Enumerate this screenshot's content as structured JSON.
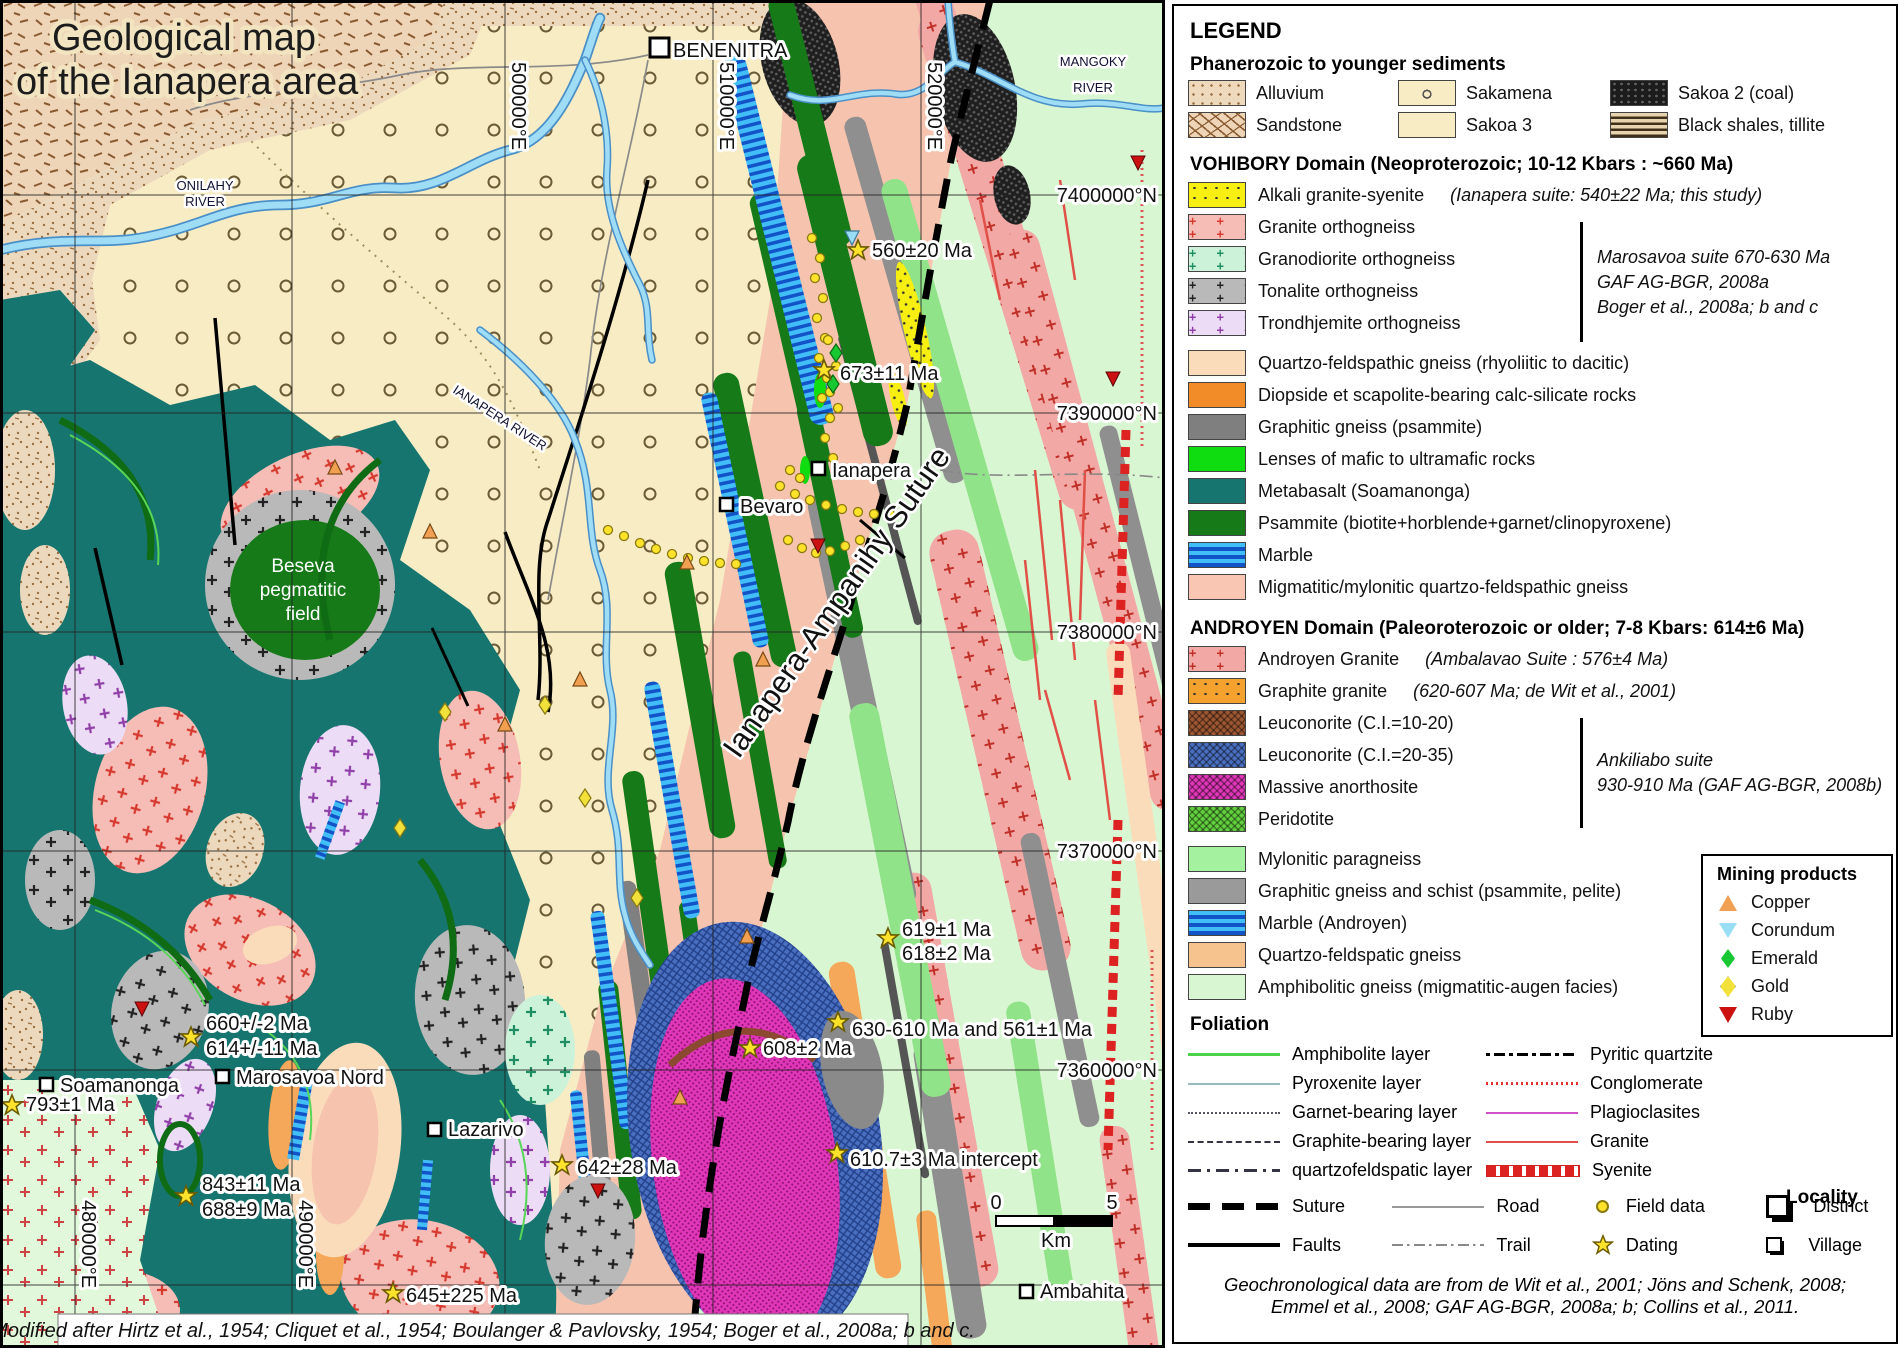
{
  "map": {
    "title": [
      "Geological map",
      "of the Ianapera area"
    ],
    "river_labels": {
      "mangoky_1": "MANGOKY",
      "mangoky_2": "RIVER",
      "onilahy_1": "ONILAHY",
      "onilahy_2": "RIVER",
      "ianapera": "IANAPERA RIVER"
    },
    "suture_label": "Ianapera-Ampanihy Suture",
    "beseva": [
      "Beseva",
      "pegmatitic",
      "field"
    ],
    "localities": {
      "benenitra": "BENENITRA",
      "ianapera": "Ianapera",
      "bevaro": "Bevaro",
      "soamanonga": "Soamanonga",
      "marosavoa_nord": "Marosavoa Nord",
      "lazarivo": "Lazarivo",
      "ambahita": "Ambahita"
    },
    "age_labels": {
      "a560": "560±20 Ma",
      "a673": "673±11 Ma",
      "a619": "619±1 Ma",
      "a618": "618±2 Ma",
      "a608": "608±2 Ma",
      "a630": "630-610 Ma and 561±1 Ma",
      "a610": "610.7±3 Ma intercept",
      "a642": "642±28 Ma",
      "a660": "660+/-2 Ma",
      "a614": "614+/-11 Ma",
      "a793": "793±1 Ma",
      "a843": "843±11 Ma",
      "a688": "688±9 Ma",
      "a645": "645±225 Ma"
    },
    "grid": {
      "eastings": [
        "480000°E",
        "490000°E",
        "500000°E",
        "510000°E",
        "520000°E"
      ],
      "northings": [
        "7400000°N",
        "7390000°N",
        "7380000°N",
        "7370000°N",
        "7360000°N"
      ]
    },
    "scale_bar": {
      "start": "0",
      "end": "5",
      "unit": "Km"
    },
    "credit": "Modified after Hirtz et al., 1954; Cliquet et al., 1954; Boulanger & Pavlovsky, 1954; Boger et al., 2008a; b and c."
  },
  "legend": {
    "title": "LEGEND",
    "sediments_header": "Phanerozoic to younger sediments",
    "sediments": [
      "Alluvium",
      "Sakamena",
      "Sakoa 2 (coal)",
      "Sandstone",
      "Sakoa 3",
      "Black shales, tillite"
    ],
    "vohibory_header": "VOHIBORY Domain (Neoproterozoic; 10-12 Kbars : ~660 Ma)",
    "vohibory_units": [
      "Alkali granite-syenite",
      "Granite orthogneiss",
      "Granodiorite orthogneiss",
      "Tonalite orthogneiss",
      "Trondhjemite orthogneiss"
    ],
    "alkali_note": "(Ianapera suite: 540±22 Ma; this study)",
    "marosavoa_note": [
      "Marosavoa suite 670-630 Ma",
      "GAF AG-BGR, 2008a",
      "Boger et al., 2008a; b and c"
    ],
    "vohibory_units2": [
      "Quartzo-feldspathic gneiss (rhyoliitic to dacitic)",
      "Diopside et scapolite-bearing calc-silicate rocks",
      "Graphitic gneiss (psammite)",
      "Lenses of mafic to ultramafic rocks",
      "Metabasalt (Soamanonga)",
      "Psammite (biotite+horblende+garnet/clinopyroxene)",
      "Marble",
      "Migmatitic/mylonitic quartzo-feldspathic gneiss"
    ],
    "androyen_header": "ANDROYEN Domain (Paleoroterozoic or older; 7-8 Kbars: 614±6 Ma)",
    "androyen_units": [
      "Androyen Granite",
      "Graphite granite",
      "Leuconorite (C.I.=10-20)",
      "Leuconorite (C.I.=20-35)",
      "Massive anorthosite",
      "Peridotite"
    ],
    "androyen_note1": "(Ambalavao Suite : 576±4 Ma)",
    "androyen_note2": "(620-607 Ma; de Wit et al., 2001)",
    "ankiliabo_note": [
      "Ankiliabo suite",
      "930-910 Ma (GAF AG-BGR, 2008b)"
    ],
    "androyen_units2": [
      "Mylonitic paragneiss",
      "Graphitic gneiss and schist (psammite, pelite)",
      "Marble (Androyen)",
      "Quartzo-feldspatic gneiss",
      "Amphibolitic gneiss (migmatitic-augen facies)"
    ],
    "foliation_header": "Foliation",
    "foliation_left": [
      "Amphibolite layer",
      "Pyroxenite layer",
      "Garnet-bearing layer",
      "Graphite-bearing layer",
      "quartzofeldspatic layer"
    ],
    "foliation_right": [
      "Pyritic quartzite",
      "Conglomerate",
      "Plagioclasites",
      "Granite",
      "Syenite"
    ],
    "mining_header": "Mining products",
    "mining": [
      "Copper",
      "Corundum",
      "Emerald",
      "Gold",
      "Ruby"
    ],
    "symbols": {
      "suture": "Suture",
      "faults": "Faults",
      "road": "Road",
      "trail": "Trail",
      "field_data": "Field data",
      "dating": "Dating"
    },
    "locality_header": "Locality",
    "locality": [
      "District",
      "Village"
    ],
    "footnote": [
      "Geochronological data are from de Wit et al., 2001; Jöns and Schenk, 2008;",
      "Emmel et al., 2008; GAF AG-BGR, 2008a; b; Collins et al., 2011."
    ]
  },
  "colors": {
    "sakoa3_beige": "#f7ecc4",
    "metabasalt_teal": "#17756f",
    "psammite_green": "#157a17",
    "marble_blue": "#41bdf7",
    "marble_stripe": "#1353c8",
    "migmatitic_pink": "#f6c3ae",
    "amphibolitic_green": "#d9f6d2",
    "anorthosite_magenta": "#e036b8",
    "leuconorite_blue": "#4a6fc0",
    "alkali_yellow": "#f7ef12",
    "field_data_yellow": "#ffe32b",
    "ruby_red": "#cc1111",
    "copper_orange": "#f0a050",
    "emerald_green": "#18c832",
    "river_blue": "#9fdcf5"
  }
}
